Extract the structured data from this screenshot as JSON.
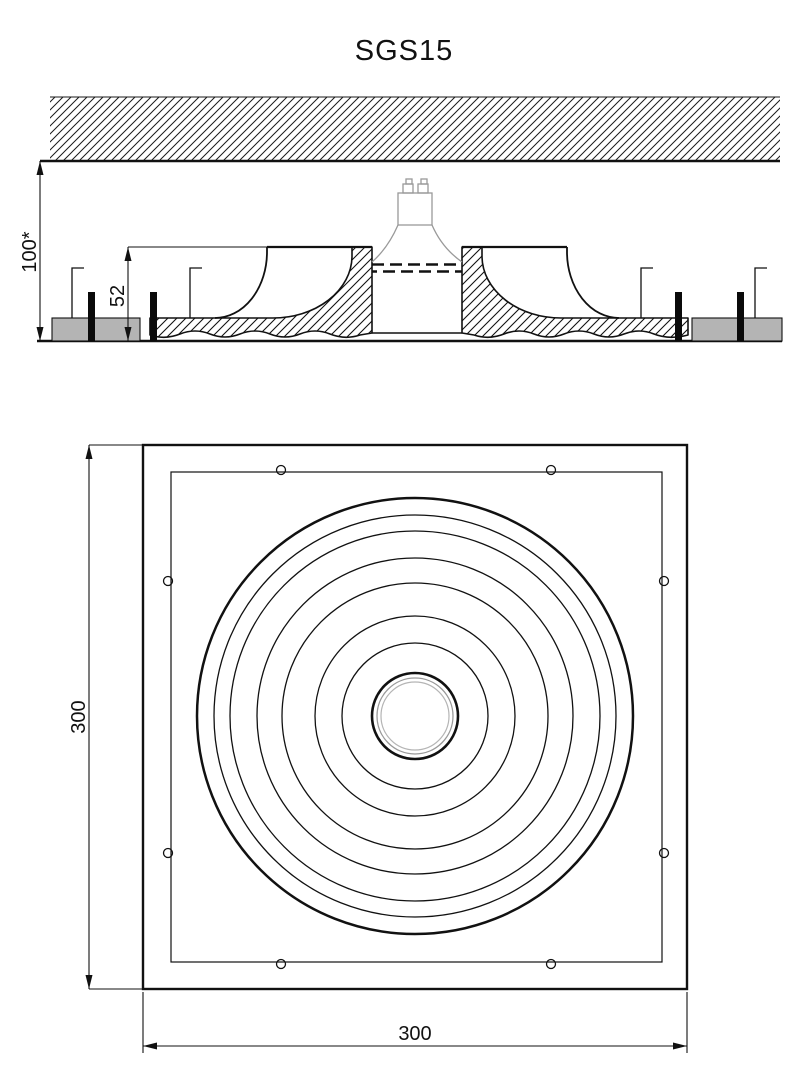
{
  "drawing": {
    "title": "SGS15",
    "section_view": {
      "dim_total_height": "100*",
      "dim_recess_depth": "52"
    },
    "plan_view": {
      "dim_height": "300",
      "dim_width": "300"
    }
  }
}
